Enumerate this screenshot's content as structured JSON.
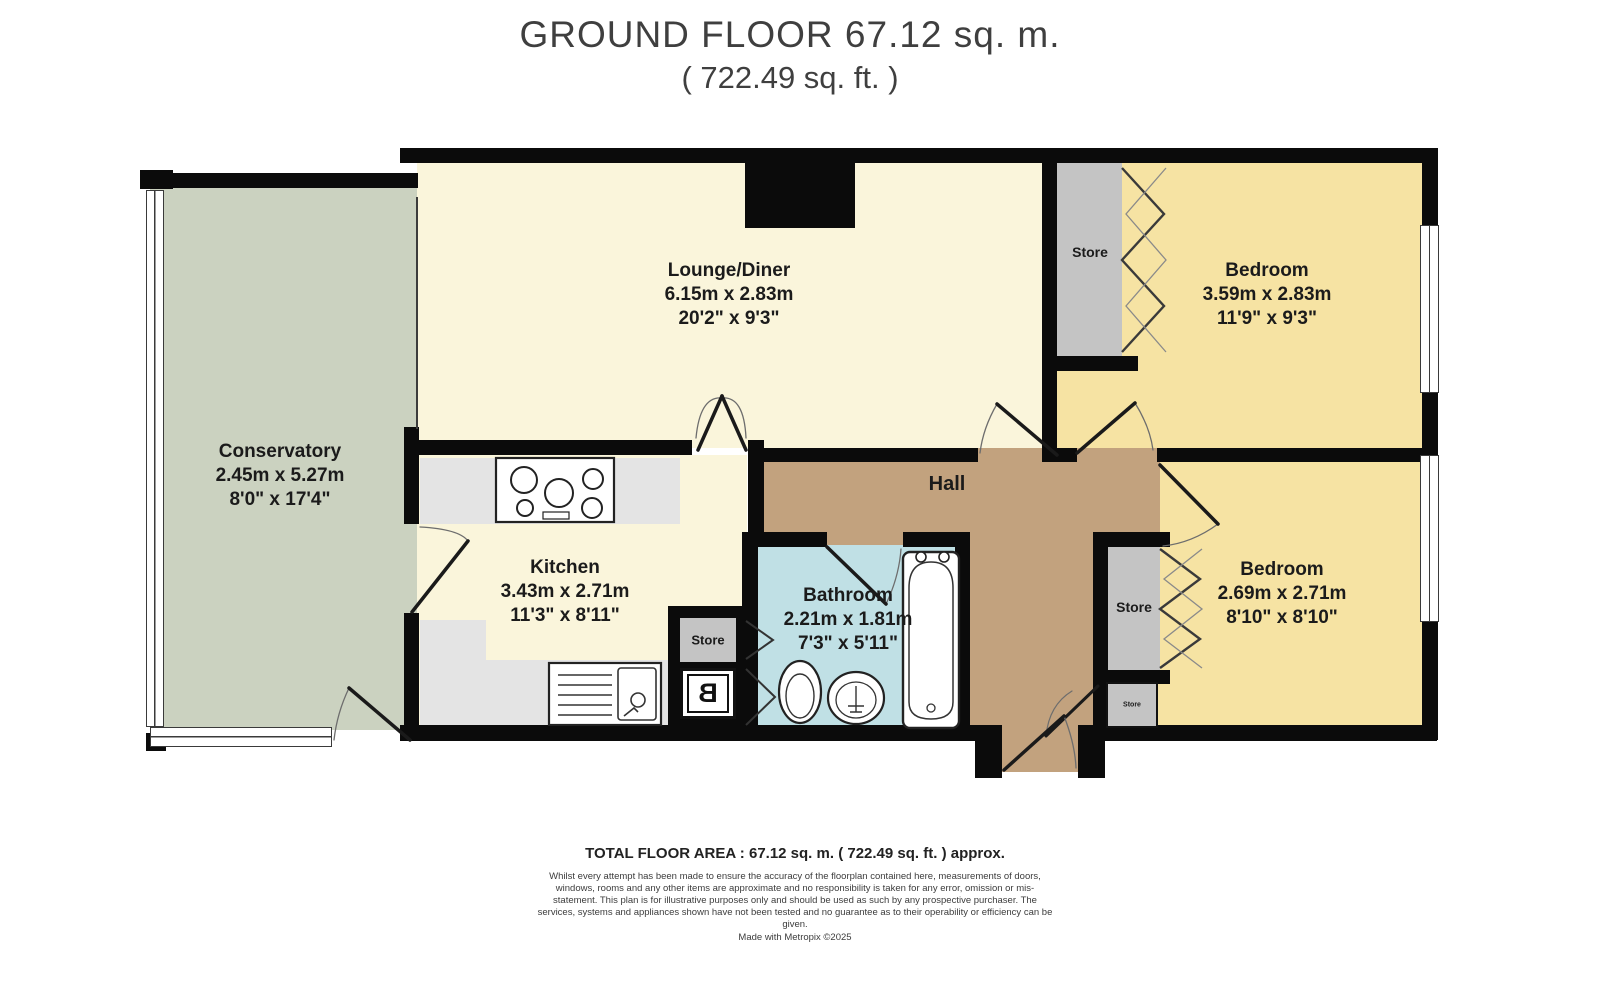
{
  "title": {
    "line1": "GROUND FLOOR 67.12 sq. m.",
    "line2": "( 722.49 sq. ft. )"
  },
  "rooms": {
    "conservatory": {
      "name": "Conservatory",
      "metric": "2.45m x 5.27m",
      "imperial": "8'0\" x 17'4\""
    },
    "lounge": {
      "name": "Lounge/Diner",
      "metric": "6.15m x 2.83m",
      "imperial": "20'2\" x 9'3\""
    },
    "kitchen": {
      "name": "Kitchen",
      "metric": "3.43m x 2.71m",
      "imperial": "11'3\" x 8'11\""
    },
    "bathroom": {
      "name": "Bathroom",
      "metric": "2.21m x 1.81m",
      "imperial": "7'3\" x 5'11\""
    },
    "hall": {
      "name": "Hall"
    },
    "bedroom_top": {
      "name": "Bedroom",
      "metric": "3.59m x 2.83m",
      "imperial": "11'9\" x 9'3\""
    },
    "bedroom_bottom": {
      "name": "Bedroom",
      "metric": "2.69m x 2.71m",
      "imperial": "8'10\" x 8'10\""
    },
    "store_top": {
      "name": "Store"
    },
    "store_mid": {
      "name": "Store"
    },
    "store_small": {
      "name": "Store"
    },
    "store_kitchen": {
      "name": "Store"
    }
  },
  "fixtures": {
    "boiler_label": "B"
  },
  "footer": {
    "total": "TOTAL FLOOR AREA : 67.12 sq. m. ( 722.49 sq. ft. ) approx.",
    "disclaimer": "Whilst every attempt has been made to ensure the accuracy of the floorplan contained here, measurements of doors, windows, rooms and any other items are approximate and no responsibility is taken for any error, omission or mis-statement. This plan is for illustrative purposes only and should be used as such by any prospective purchaser. The services, systems and appliances shown have not been tested and no guarantee as to their operability or efficiency can be given.",
    "credit": "Made with Metropix ©2025"
  },
  "colors": {
    "wall": "#0b0b0b",
    "lounge_kitchen": "#faf5db",
    "bedroom": "#f6e3a3",
    "conservatory": "#cbd2c0",
    "hall": "#c2a27e",
    "bathroom": "#c0e0e5",
    "store": "#c4c4c4",
    "counter": "#e4e4e4"
  }
}
